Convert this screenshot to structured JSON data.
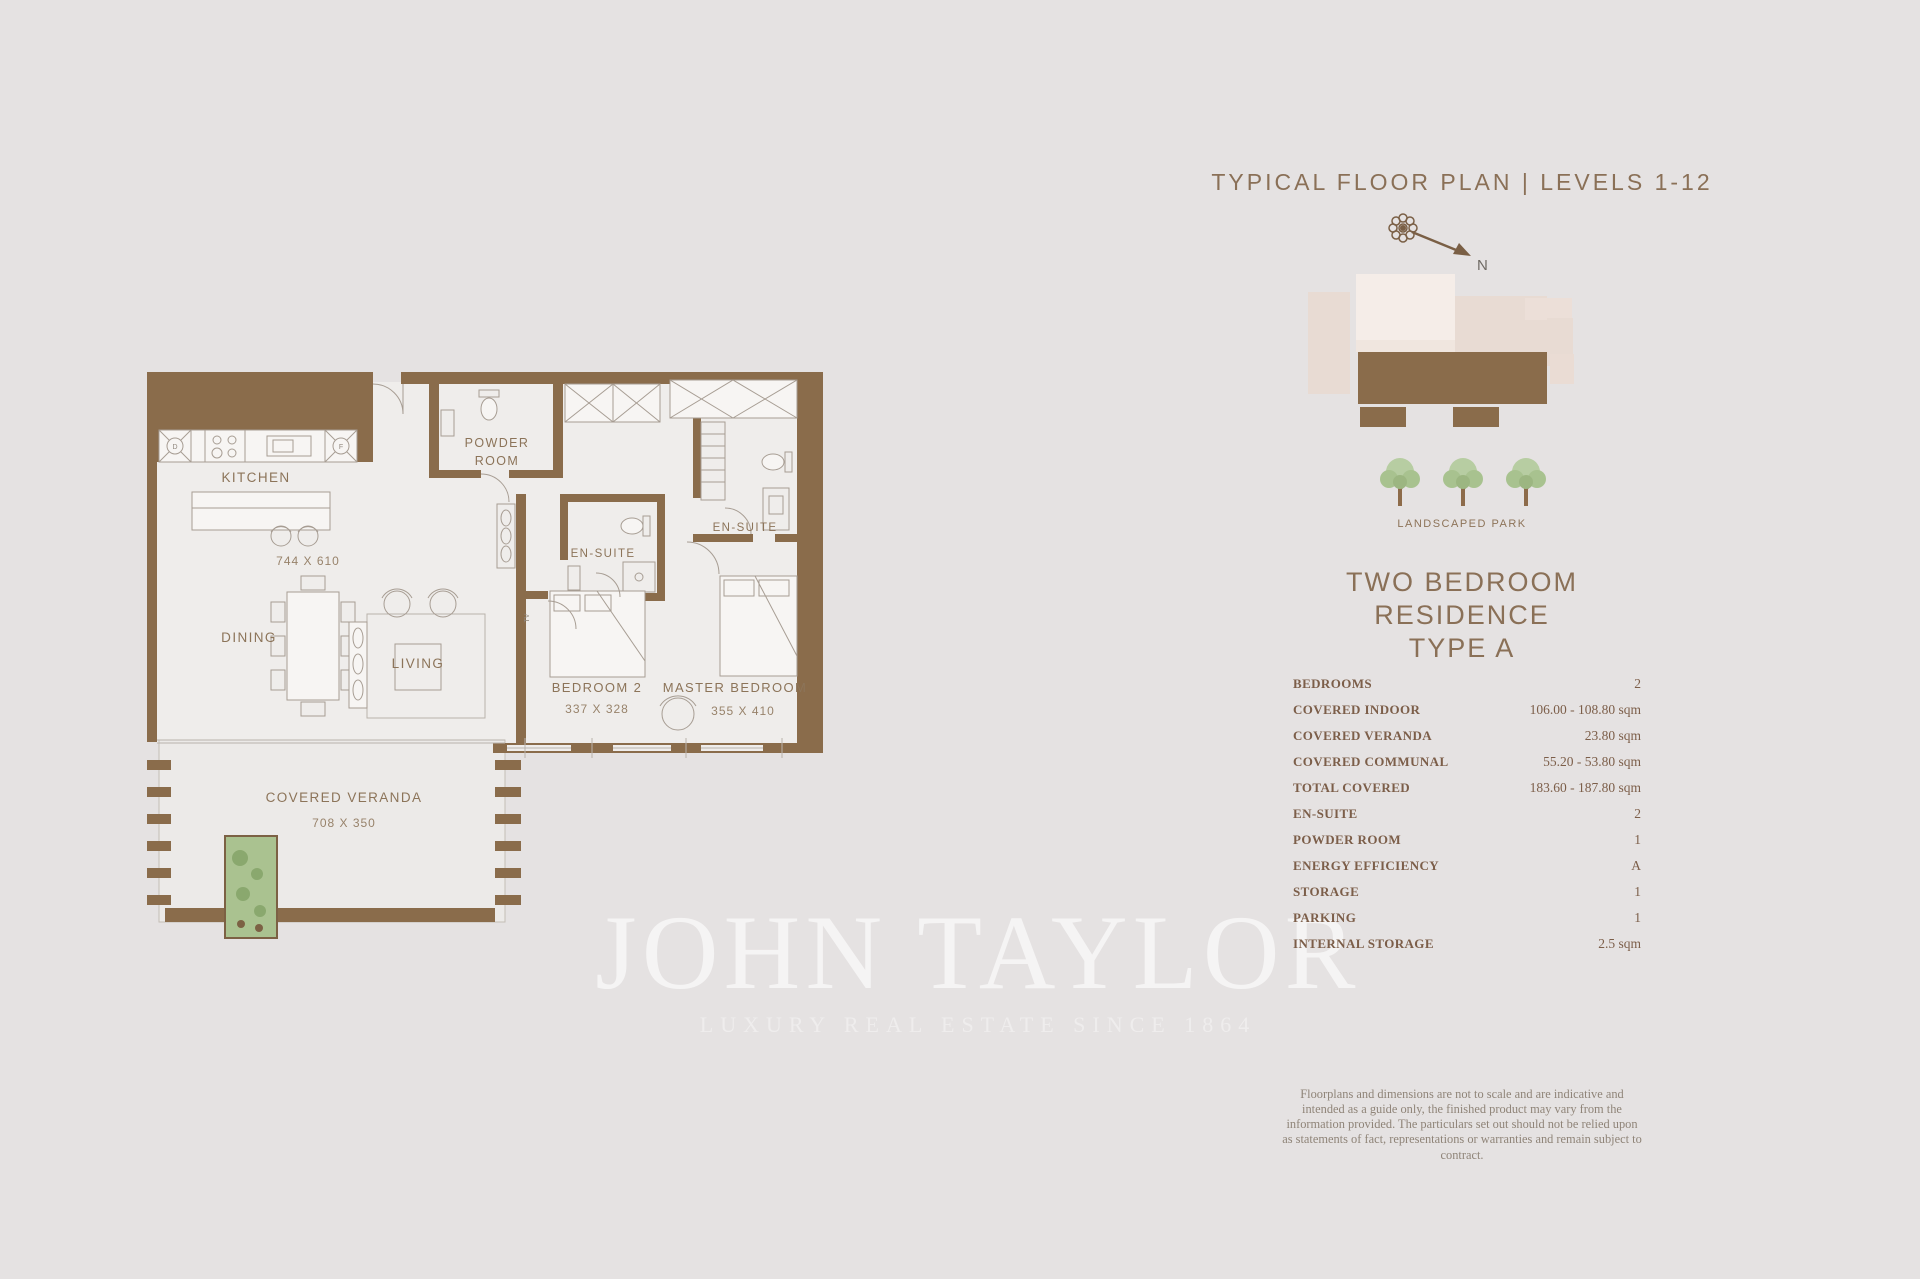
{
  "page": {
    "background": "#e5e2e2",
    "wall_brown": "#8a6c4b",
    "accent_text": "#8a7057"
  },
  "header": {
    "title": "TYPICAL FLOOR PLAN | LEVELS 1-12"
  },
  "compass": {
    "north_label": "N"
  },
  "site": {
    "park_label": "LANDSCAPED PARK"
  },
  "residence": {
    "line1": "TWO BEDROOM RESIDENCE",
    "line2": "TYPE A"
  },
  "specs": {
    "rows": [
      {
        "label": "BEDROOMS",
        "value": "2"
      },
      {
        "label": "COVERED INDOOR",
        "value": "106.00 - 108.80 sqm"
      },
      {
        "label": "COVERED VERANDA",
        "value": "23.80 sqm"
      },
      {
        "label": "COVERED COMMUNAL",
        "value": "55.20 - 53.80 sqm"
      },
      {
        "label": "TOTAL COVERED",
        "value": "183.60 - 187.80 sqm"
      },
      {
        "label": "EN-SUITE",
        "value": "2"
      },
      {
        "label": "POWDER ROOM",
        "value": "1"
      },
      {
        "label": "ENERGY EFFICIENCY",
        "value": "A"
      },
      {
        "label": "STORAGE",
        "value": "1"
      },
      {
        "label": "PARKING",
        "value": "1"
      },
      {
        "label": "INTERNAL STORAGE",
        "value": "2.5 sqm"
      }
    ]
  },
  "disclaimer": {
    "text": "Floorplans and dimensions are not to scale and are indicative and intended as a guide only, the finished product may vary from the information provided. The particulars set out should not be relied upon as statements of fact, representations or warranties and remain subject to contract."
  },
  "watermark": {
    "brand": "JOHN TAYLOR",
    "tagline": "LUXURY REAL ESTATE SINCE 1864"
  },
  "plan": {
    "kitchen": "KITCHEN",
    "kitchen_dims": "744 X 610",
    "dining": "DINING",
    "living": "LIVING",
    "powder_line1": "POWDER",
    "powder_line2": "ROOM",
    "ensuite_bedroom2": "EN-SUITE",
    "ensuite_master": "EN-SUITE",
    "bedroom2": "BEDROOM 2",
    "bedroom2_dims": "337 X 328",
    "master": "MASTER BEDROOM",
    "master_dims": "355 X 410",
    "veranda": "COVERED VERANDA",
    "veranda_dims": "708 X 350",
    "appliance_d": "D",
    "appliance_f": "F",
    "tv": "TV"
  }
}
